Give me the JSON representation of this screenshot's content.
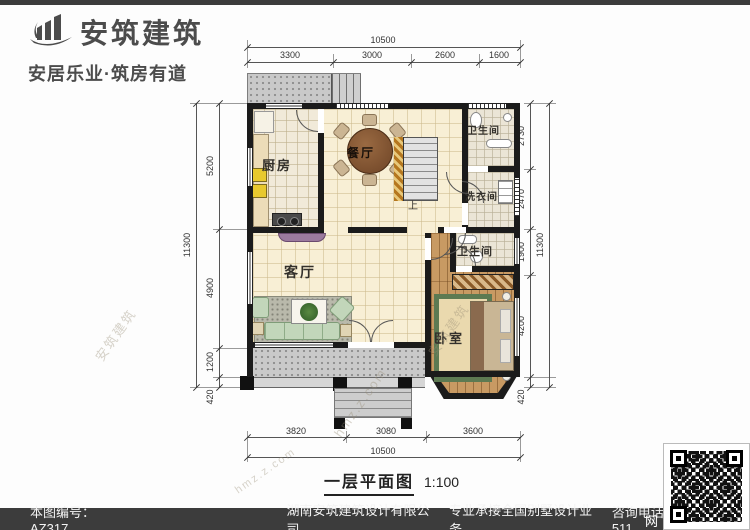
{
  "brand": {
    "name": "安筑建筑",
    "tagline": "安居乐业·筑房有道",
    "logo_icon": "building-swoosh-icon"
  },
  "plan": {
    "title": "一层平面图",
    "scale": "1:100",
    "stair_label": "上",
    "rooms": [
      {
        "id": "kitchen",
        "label": "厨房"
      },
      {
        "id": "dining",
        "label": "餐厅"
      },
      {
        "id": "bath-top",
        "label": "卫生间"
      },
      {
        "id": "laundry",
        "label": "洗衣间"
      },
      {
        "id": "living",
        "label": "客厅"
      },
      {
        "id": "bath-bedroom",
        "label": "卫生间"
      },
      {
        "id": "bedroom",
        "label": "卧室"
      }
    ],
    "dimensions": {
      "top": {
        "overall": "10500",
        "segments": [
          "3300",
          "3000",
          "2600",
          "1600"
        ]
      },
      "bottom": {
        "overall": "10500",
        "segments": [
          "3820",
          "3080",
          "3600"
        ]
      },
      "left": {
        "overall": "11300",
        "segments": [
          "5200",
          "4900",
          "1200",
          "420"
        ]
      },
      "right": {
        "overall": "11300",
        "segments": [
          "2730",
          "2470",
          "1900",
          "4200",
          "420"
        ]
      }
    }
  },
  "footer": {
    "drawing_no": "本图编号：AZ317",
    "company": "湖南安筑建筑设计有限公司",
    "service": "专业承接全国别墅设计业务",
    "phone": "咨询电话：400-8070-511",
    "qr_side_text": "网",
    "qr_icon": "qr-code"
  },
  "watermarks": [
    "安筑建筑",
    "hmz.z.com"
  ],
  "colors": {
    "wall": "#1b1b1b",
    "floor_cream": "#f8efd5",
    "floor_wood": "#c89a63",
    "porch_gray": "#c9c9c9",
    "bar_dark": "#3c3c3c",
    "stair_hatch": "#c8842a"
  }
}
